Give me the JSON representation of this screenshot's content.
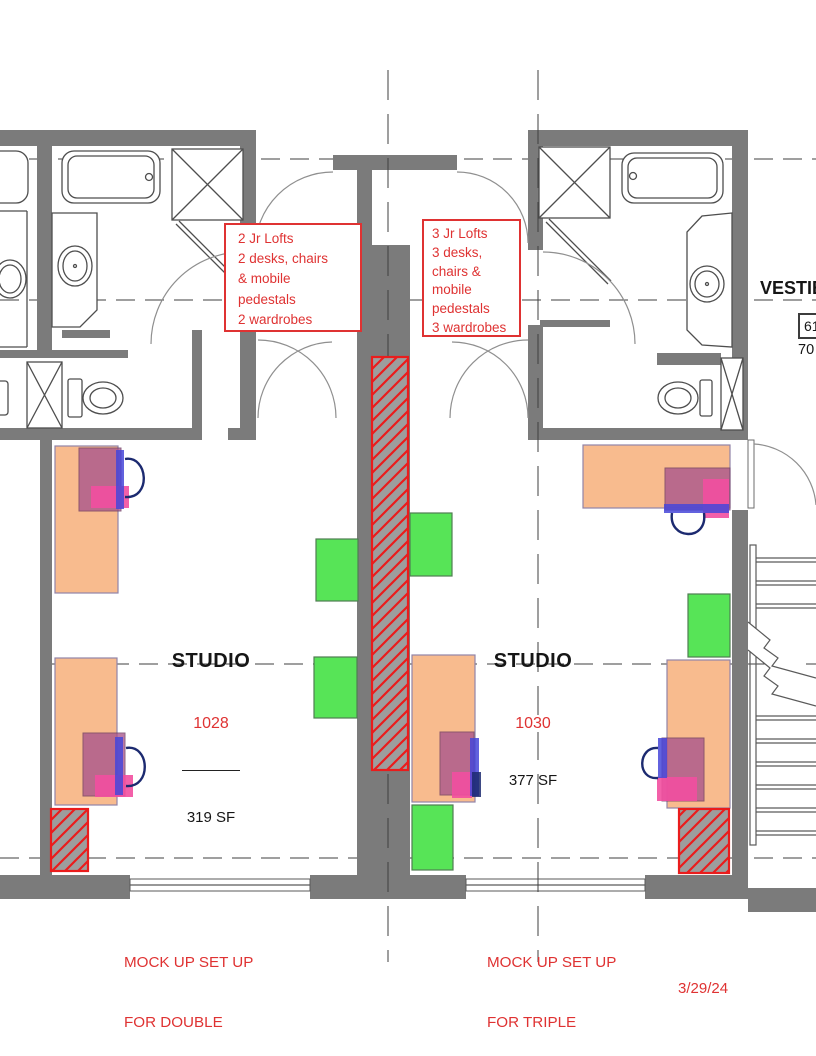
{
  "notes": {
    "left": {
      "lines": [
        "2 Jr Lofts",
        "2 desks, chairs",
        "& mobile",
        "pedestals",
        "2 wardrobes"
      ]
    },
    "right": {
      "lines": [
        "3 Jr Lofts",
        "3 desks,",
        "chairs &",
        "mobile",
        "pedestals",
        "3 wardrobes"
      ]
    }
  },
  "rooms": {
    "studio_left": {
      "name": "STUDIO",
      "number": "1028",
      "area": "319 SF"
    },
    "studio_right": {
      "name": "STUDIO",
      "number": "1030",
      "area": "377 SF"
    },
    "vestibule": {
      "name": "VESTIB",
      "number": "61",
      "area": "70"
    }
  },
  "captions": {
    "left": {
      "line1": "MOCK UP SET UP",
      "line2": "FOR DOUBLE"
    },
    "right": {
      "line1": "MOCK UP SET UP",
      "line2": "FOR TRIPLE"
    }
  },
  "date": "3/29/24",
  "colors": {
    "wall_gray": "#7b7b7b",
    "annotation_red": "#df3232",
    "hatch_red": "#ea1c1c",
    "desk_orange": "#f8bb8e",
    "chair_mauve": "#a8548c",
    "pedestal_pink": "#f24fa0",
    "chair_blue": "#4646d8",
    "chair_back_navy": "#1c2a70",
    "wardrobe_green": "#57e457"
  }
}
